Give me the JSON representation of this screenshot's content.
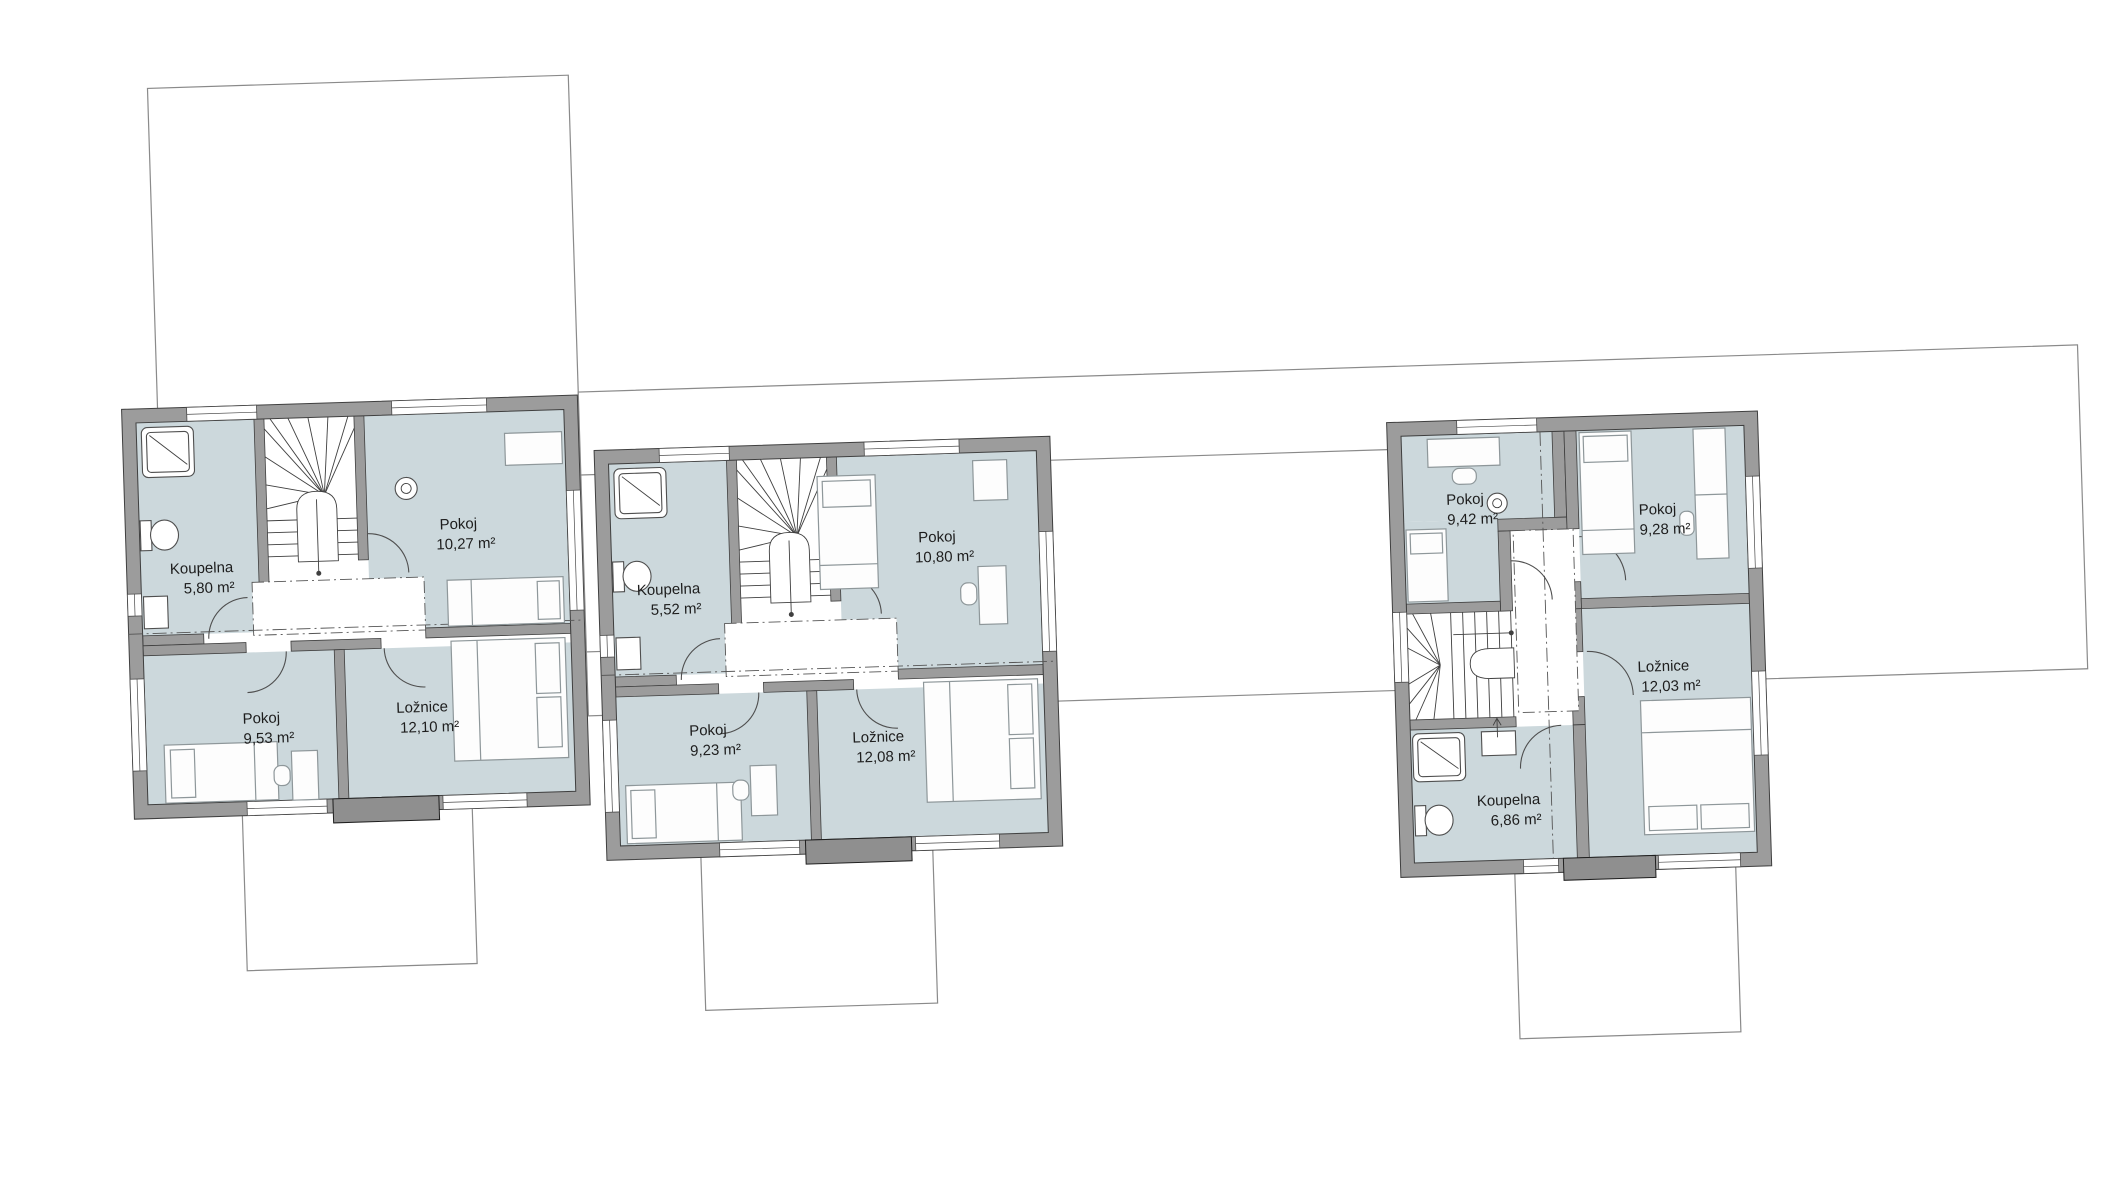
{
  "drawing": {
    "kind": "floor-plan",
    "language": "cs",
    "units": "m²"
  },
  "colors": {
    "wall_gray": "#9c9c9c",
    "wall_block_gray": "#8f8f8f",
    "room_fill": "#ccd8dc",
    "line_dark": "#3f3f3f",
    "outline_gray": "#8a8a8a",
    "background": "#ffffff"
  },
  "houses": [
    {
      "id": "house-1",
      "rooms": [
        {
          "name": "Koupelna",
          "area": "5,80 m²"
        },
        {
          "name": "Pokoj",
          "area": "10,27 m²"
        },
        {
          "name": "Pokoj",
          "area": "9,53 m²"
        },
        {
          "name": "Ložnice",
          "area": "12,10 m²"
        }
      ]
    },
    {
      "id": "house-2",
      "rooms": [
        {
          "name": "Koupelna",
          "area": "5,52 m²"
        },
        {
          "name": "Pokoj",
          "area": "10,80 m²"
        },
        {
          "name": "Pokoj",
          "area": "9,23 m²"
        },
        {
          "name": "Ložnice",
          "area": "12,08 m²"
        }
      ]
    },
    {
      "id": "house-3",
      "rooms": [
        {
          "name": "Pokoj",
          "area": "9,42 m²"
        },
        {
          "name": "Pokoj",
          "area": "9,28 m²"
        },
        {
          "name": "Ložnice",
          "area": "12,03 m²"
        },
        {
          "name": "Koupelna",
          "area": "6,86 m²"
        }
      ]
    }
  ]
}
